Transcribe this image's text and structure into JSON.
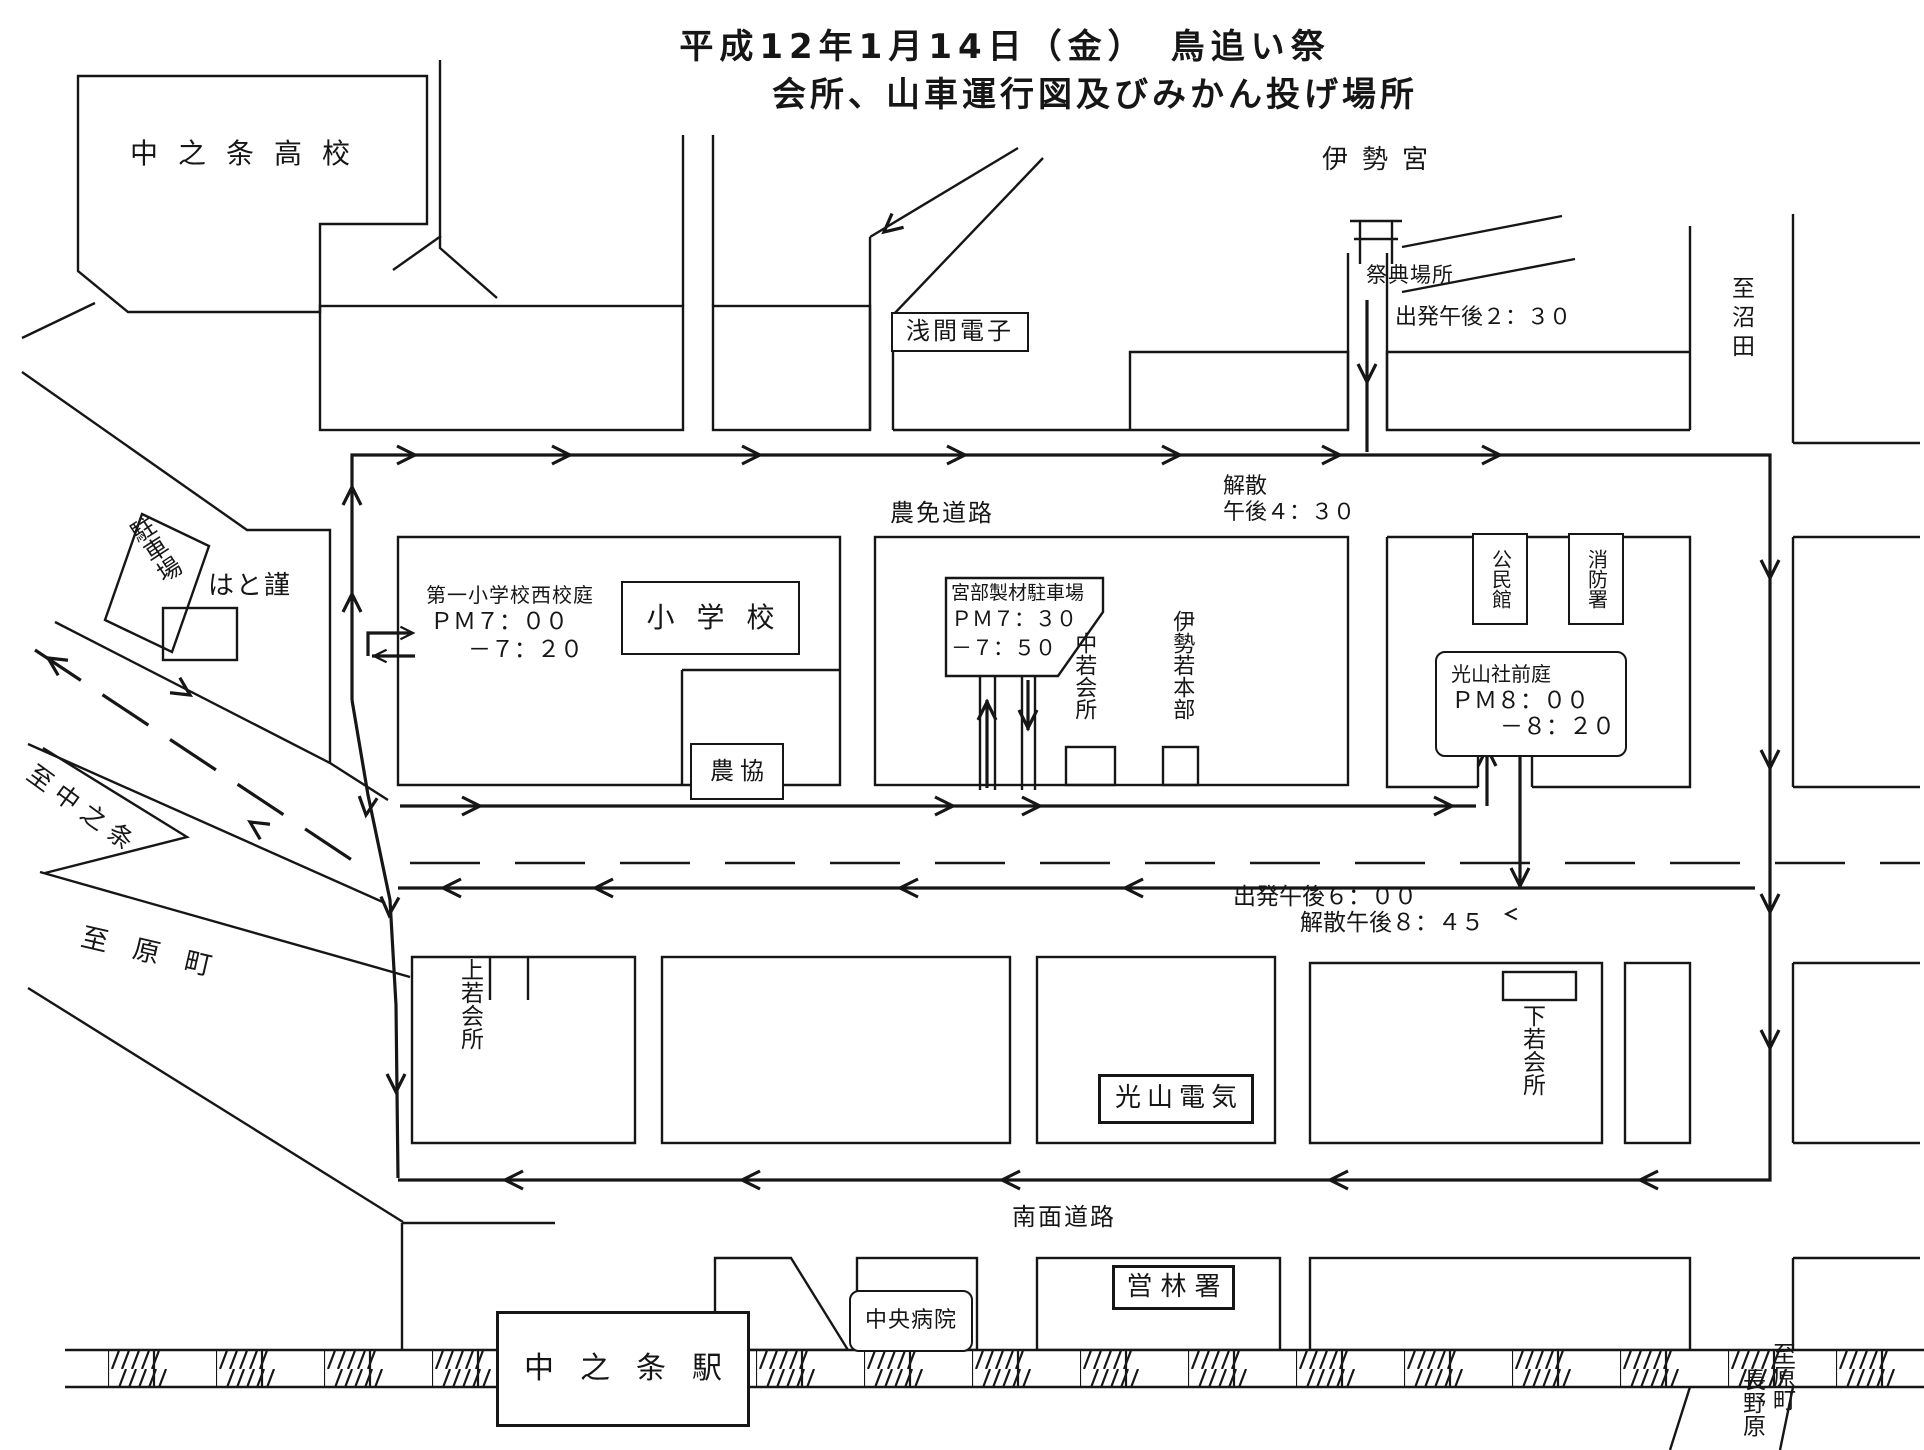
{
  "title": {
    "line1": "平成12年1月14日（金）　鳥追い祭",
    "line2": "会所、山車運行図及びみかん投げ場所"
  },
  "landmarks": {
    "highschool": "中之条高校",
    "asama_denshi": "浅間電子",
    "ise_shrine": "伊勢宮",
    "festival_site": "祭典場所",
    "to_numata": "至沼田",
    "parking": "駐車場",
    "hato": "はと謹",
    "nomen_road": "農免道路",
    "school_yard": "第一小学校西校庭",
    "school_yard_time1": "ＰＭ７：００",
    "school_yard_time2": "－７：２０",
    "elementary_school": "小学校",
    "nokyo": "農協",
    "miyabe_lot": "宮部製材駐車場",
    "miyabe_time1": "ＰＭ７：３０",
    "miyabe_time2": "－７：５０",
    "nakawaka_kaisho": "中若会所",
    "isewaka_honbu": "伊勢若本部",
    "kominkan": "公民館",
    "fire_station": "消防署",
    "kozansha_garden": "光山社前庭",
    "kozansha_time1": "ＰＭ８：００",
    "kozansha_time2": "－８：２０",
    "to_nakanojo": "至中之条",
    "to_haramachi": "至原町",
    "kamiwaka_kaisho": "上若会所",
    "shimowaka_kaisho": "下若会所",
    "kozan_denki": "光山電気",
    "nanmen_road": "南面道路",
    "chuo_hospital": "中央病院",
    "eirinsho": "営林署",
    "station": "中之条駅",
    "bottom_right_dest1": "至原町",
    "bottom_right_dest2": "長野原"
  },
  "route_notes": {
    "depart_230": "出発午後２：３０",
    "disband_430_l1": "解散",
    "disband_430_l2": "午後４：３０",
    "depart_600": "出発午後６：００",
    "disband_845": "解散午後８：４５"
  },
  "colors": {
    "ink": "#161616",
    "paper": "#ffffff"
  }
}
